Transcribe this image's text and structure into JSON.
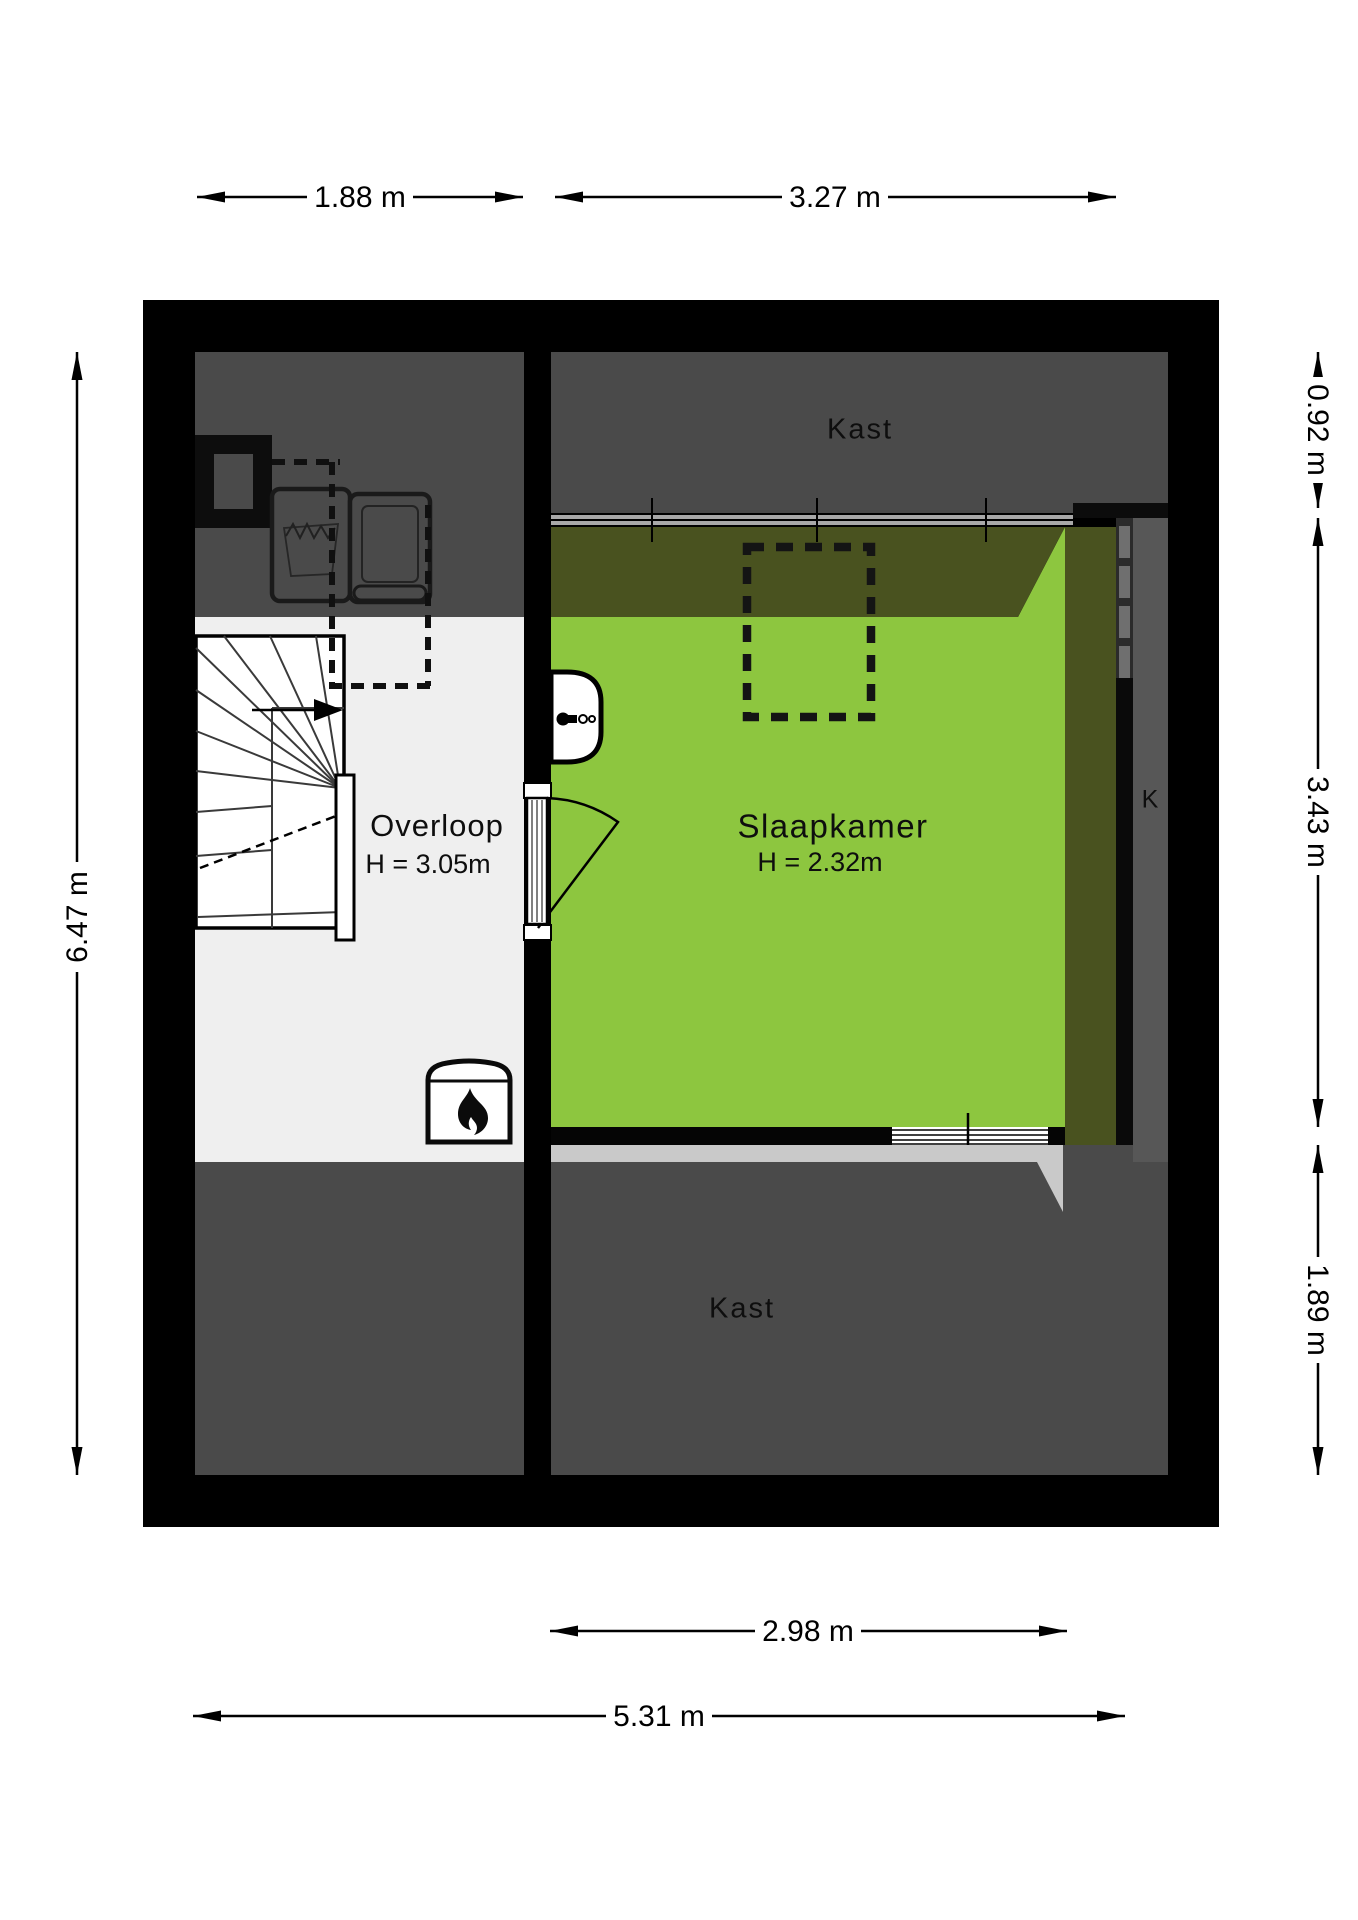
{
  "floorplan": {
    "rooms": {
      "kast_top": {
        "label": "Kast"
      },
      "slaapkamer": {
        "label": "Slaapkamer",
        "height": "H = 2.32m"
      },
      "overloop": {
        "label": "Overloop",
        "height": "H = 3.05m"
      },
      "kast_bottom": {
        "label": "Kast"
      },
      "k_closet": {
        "label": "K"
      }
    },
    "dimensions": {
      "top": [
        {
          "label": "1.88 m"
        },
        {
          "label": "3.27 m"
        }
      ],
      "bottom": [
        {
          "label": "2.98 m"
        },
        {
          "label": "5.31 m"
        }
      ],
      "left": [
        {
          "label": "6.47 m"
        }
      ],
      "right": [
        {
          "label": "0.92 m"
        },
        {
          "label": "3.43 m"
        },
        {
          "label": "1.89 m"
        }
      ]
    },
    "icons": {
      "stove": "flame-icon",
      "toilet": "toilet-icon",
      "stairs": "staircase-icon",
      "washer": "washing-machine-icon",
      "dryer": "dryer-icon",
      "skylight": "dashed-skylight-outline",
      "sliding_door": "sliding-door-dashes"
    },
    "colors": {
      "wall": "#000000",
      "room_dark": "#4a4a4a",
      "floor_light": "#efefef",
      "bedroom_green": "#8dc63f",
      "low_ceiling_olive": "#49521f",
      "sill_gray": "#c9c9c9",
      "closet_gray": "#575757",
      "track_dark": "#2b2b2b"
    }
  }
}
